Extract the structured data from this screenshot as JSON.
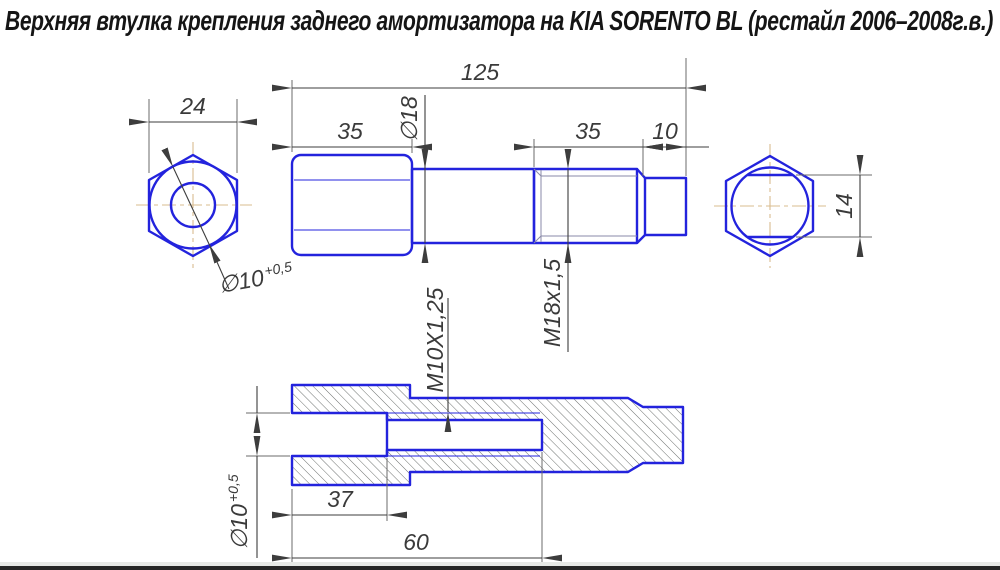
{
  "title": "Верхняя втулка крепления заднего амортизатора на KIA SORENTO BL (рестайл 2006–2008г.в.)",
  "colors": {
    "outline_blue": "#2323dd",
    "dimension_gray": "#3d3d3d",
    "centerline_tan": "#d9bc8f",
    "hatch_gray": "#6e7270",
    "background": "#ffffff",
    "title_text": "#151515"
  },
  "views": {
    "left_end": {
      "across_flats": "24",
      "bore_dia": "∅10",
      "bore_tol": "+0,5"
    },
    "main": {
      "overall_length": "125",
      "hex_length": "35",
      "shaft_dia": "∅18",
      "thread_length": "35",
      "tip_length": "10",
      "thread_spec": "M18x1,5"
    },
    "right_end": {
      "across_flats": "14"
    },
    "section": {
      "bore_dia": "∅10",
      "bore_tol": "+0,5",
      "bore_depth": "37",
      "thread_depth": "60",
      "thread_spec": "M10X1,25"
    }
  }
}
